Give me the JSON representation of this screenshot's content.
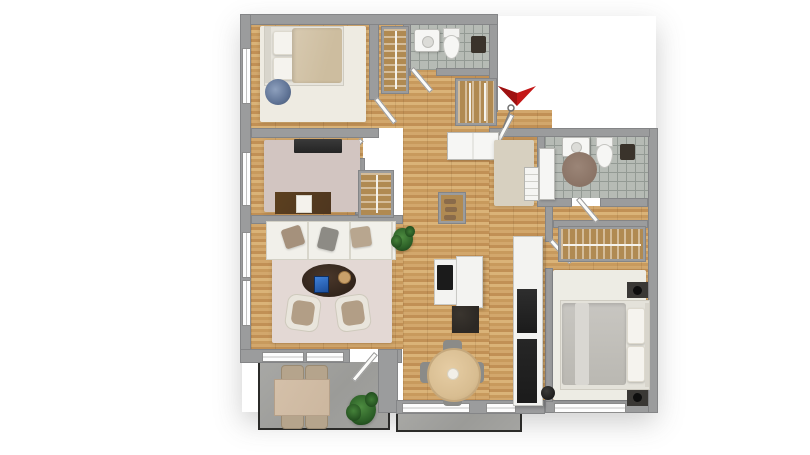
{
  "scene": {
    "type": "3d-rendered-floor-plan",
    "view": "top-down",
    "background": "#ffffff",
    "visible_text": "none"
  },
  "palette": {
    "wall": "#9b9c9d",
    "wall_edge": "#848587",
    "wood_a": "#d2a76c",
    "wood_b": "#c19055",
    "wood_c": "#dab378",
    "wood_d": "#c89a5d",
    "tile": "#b6bbb5",
    "tile_line": "#939a94",
    "window_white": "#fdfdfd",
    "door_white": "#fbfbf9",
    "cabinet_white": "#f6f6f4",
    "sofa_white": "#f1f0ea",
    "armchair": "#b29e86",
    "rug_white": "#eeebe2",
    "rug_mauve": "#d2c5c1",
    "rug_living": "#e3d8d4",
    "rug_entry": "#d7d0c0",
    "rug_bedroom2": "#edece4",
    "rug_round_brown": "#8a7365",
    "bed1_duvet": "#d8cab1",
    "bed2_duvet": "#c8c6c1",
    "pillow_white": "#f5f3ee",
    "pillow_taupe": "#a5917c",
    "pillow_gray": "#8d8b85",
    "pouf_blue": "#5f7395",
    "coffee_table": "#30231a",
    "desk_wood": "#4e361f",
    "tv_black": "#242424",
    "island_white": "#f3f3f1",
    "appliance_black": "#1b1b1b",
    "counter_dark": "#2c2824",
    "dining_table": "#d8bd91",
    "chair_gray": "#8b8b88",
    "balcony_table": "#ccb79f",
    "balcony_chair": "#b5a48c",
    "wardrobe_wood": "#b08a52",
    "fixture_dark": "#3a332b",
    "nightstand_dark": "#3a3835",
    "arrow_red": "#c41717",
    "concrete": "#a3a3a0"
  },
  "rooms": {
    "bedroom1": {
      "label": "Bedroom 1 (top-left)"
    },
    "office": {
      "label": "Office / kids room"
    },
    "living": {
      "label": "Living room"
    },
    "bathroom1": {
      "label": "Bathroom 1 (top)"
    },
    "hallway": {
      "label": "Hallway / entrance"
    },
    "kitchen": {
      "label": "Kitchen"
    },
    "dining": {
      "label": "Dining area"
    },
    "bathroom2": {
      "label": "Bathroom 2 (right)"
    },
    "bedroom2": {
      "label": "Bedroom 2 (right)"
    },
    "balcony_main": {
      "label": "Balcony terrace (bottom-left)"
    },
    "balcony_small": {
      "label": "Balcony strip (bottom-center)"
    }
  },
  "objects": {
    "bed1": {
      "label": "Double bed with beige duvet"
    },
    "pouf1": {
      "label": "Round blue patterned pouf"
    },
    "closet1": {
      "label": "Built-in wardrobe with hangers"
    },
    "sink1": {
      "label": "Washbasin"
    },
    "toilet1": {
      "label": "Toilet"
    },
    "shower_fixture1": {
      "label": "Dark wall fixture / shower"
    },
    "tv_office": {
      "label": "TV / media board"
    },
    "desk": {
      "label": "Desk with paper"
    },
    "office_closet": {
      "label": "Wardrobe niche with hangers"
    },
    "sofa": {
      "label": "White sofa with pillows"
    },
    "coffee_table": {
      "label": "Dark oval coffee table with tablet and tray"
    },
    "armchair_left": {
      "label": "Armchair"
    },
    "armchair_right": {
      "label": "Armchair"
    },
    "plant_living": {
      "label": "Potted plant"
    },
    "hall_wardrobe": {
      "label": "Open wardrobe with hangers"
    },
    "hall_sideboard": {
      "label": "White sideboard"
    },
    "shoe_cabinet": {
      "label": "Shoe cabinet"
    },
    "entry_rug": {
      "label": "Entrance rug"
    },
    "radiator": {
      "label": "Radiator"
    },
    "kitchen_tall_unit": {
      "label": "Kitchen tall unit with black appliances"
    },
    "kitchen_island": {
      "label": "Kitchen island with cooktop"
    },
    "kitchen_counter_dark": {
      "label": "Dark stone counter"
    },
    "dining_table": {
      "label": "Round dining table with 4 chairs"
    },
    "cabinet2": {
      "label": "Tall white bathroom cabinet"
    },
    "sink2": {
      "label": "Washbasin"
    },
    "toilet2": {
      "label": "Toilet"
    },
    "round_rug2": {
      "label": "Round brown rug"
    },
    "shower_fixture2": {
      "label": "Dark wall fixture / shower"
    },
    "wardrobe_bed2": {
      "label": "Open wardrobe with hangers"
    },
    "bed2": {
      "label": "Double bed with gray duvet"
    },
    "nightstand_top": {
      "label": "Nightstand with black lamp"
    },
    "nightstand_bottom": {
      "label": "Nightstand with black lamp"
    },
    "black_pot": {
      "label": "Black plant pot"
    },
    "balcony_table": {
      "label": "Balcony dining table"
    },
    "balcony_chairs": {
      "label": "Four balcony chairs"
    },
    "plant_balcony": {
      "label": "Potted plant"
    }
  },
  "markers": {
    "entrance_arrow": {
      "label": "Red entrance direction arrow",
      "color": "#c41717"
    },
    "entrance_key": {
      "label": "Key symbol at entrance door"
    }
  }
}
